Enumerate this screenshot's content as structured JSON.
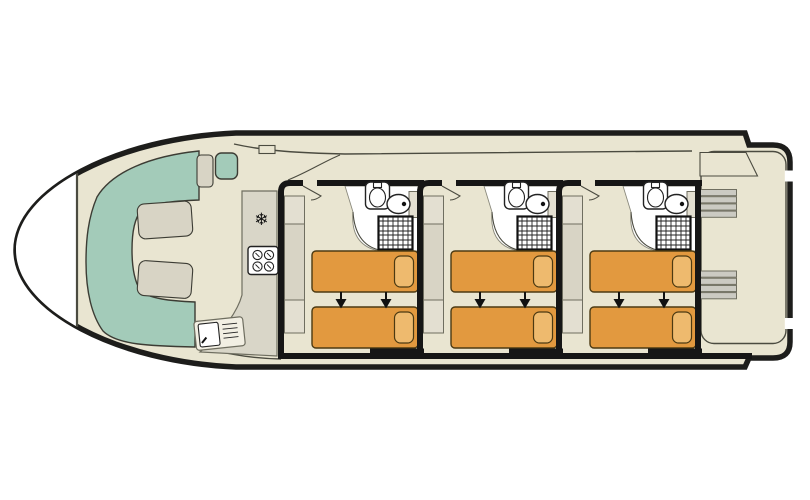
{
  "plan": {
    "type": "boat-deck-floor-plan",
    "cabin_count": 3,
    "beds_per_cabin": 2,
    "bathroom_count": 3
  },
  "colors": {
    "exterior": "#ffffff",
    "hull_outline": "#1d1d1b",
    "interior": "#e9e5d1",
    "wall": "#161616",
    "line_dark": "#4b4b40",
    "outline_dark": "#3c3c34",
    "outline_mid": "#6f6e60",
    "seating_teal": "#a3cbb9",
    "cushion_grey": "#d8d4c5",
    "cushion_light": "#e3dfd1",
    "counter_grey": "#d9d6c8",
    "bed_orange": "#e2993f",
    "pillow_orange": "#eeba6e",
    "bed_outline": "#4c3a12",
    "fixture_outline": "#222222",
    "stair_grey": "#cbcac2",
    "unit_white": "#f2efe3"
  },
  "bow_lounge": {
    "seating": "u-shaped-bench",
    "bench_cushions": 2,
    "side_seats": 2
  },
  "galley": {
    "fridge_icon": "❄",
    "hob_burners": 4,
    "sink": "sink-with-drainer"
  },
  "cabins": [
    {
      "id": "cabin-1",
      "beds": 2,
      "join_arrows": 2,
      "wardrobe": true,
      "bathroom": [
        "washbasin",
        "toilet",
        "shower"
      ]
    },
    {
      "id": "cabin-2",
      "beds": 2,
      "join_arrows": 2,
      "wardrobe": true,
      "bathroom": [
        "washbasin",
        "toilet",
        "shower"
      ]
    },
    {
      "id": "cabin-3",
      "beds": 2,
      "join_arrows": 2,
      "wardrobe": true,
      "bathroom": [
        "washbasin",
        "toilet",
        "shower"
      ]
    }
  ],
  "stern": {
    "staircases": 2,
    "steps_each": 4,
    "side_gates": 2
  }
}
